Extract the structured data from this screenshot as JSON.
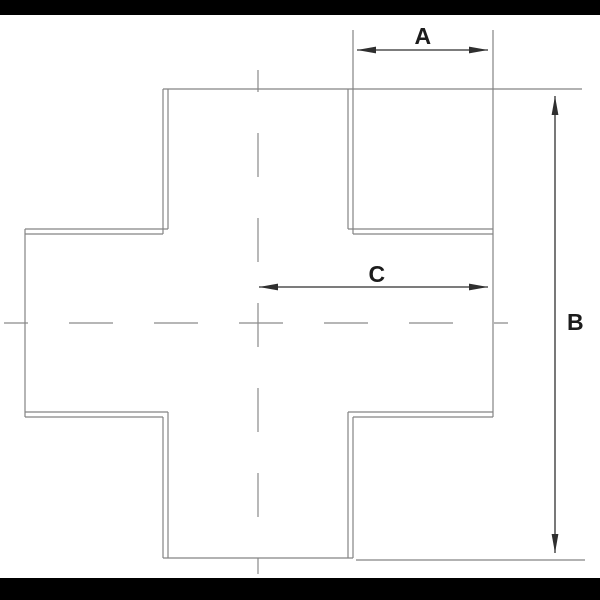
{
  "figure": {
    "type": "technical dimension drawing",
    "subject": "four-way cross (plus-shaped) part, plan view with center lines",
    "background": "#ffffff"
  },
  "bars": {
    "color": "#000000",
    "top_height_px": 15,
    "bottom_height_px": 22
  },
  "colors": {
    "part_line": "#848484",
    "centerline": "#8a8a8a",
    "dimension": "#2f2f2f",
    "text": "#1c1c1c"
  },
  "dimensions": [
    {
      "label": "A",
      "orientation": "horizontal",
      "location": "top right",
      "spans": "side-arm length (vertical-arm edge to right arm end)"
    },
    {
      "label": "B",
      "orientation": "vertical",
      "location": "right side",
      "spans": "overall height of cross"
    },
    {
      "label": "C",
      "orientation": "horizontal",
      "location": "middle right",
      "spans": "center line to right arm end"
    }
  ]
}
